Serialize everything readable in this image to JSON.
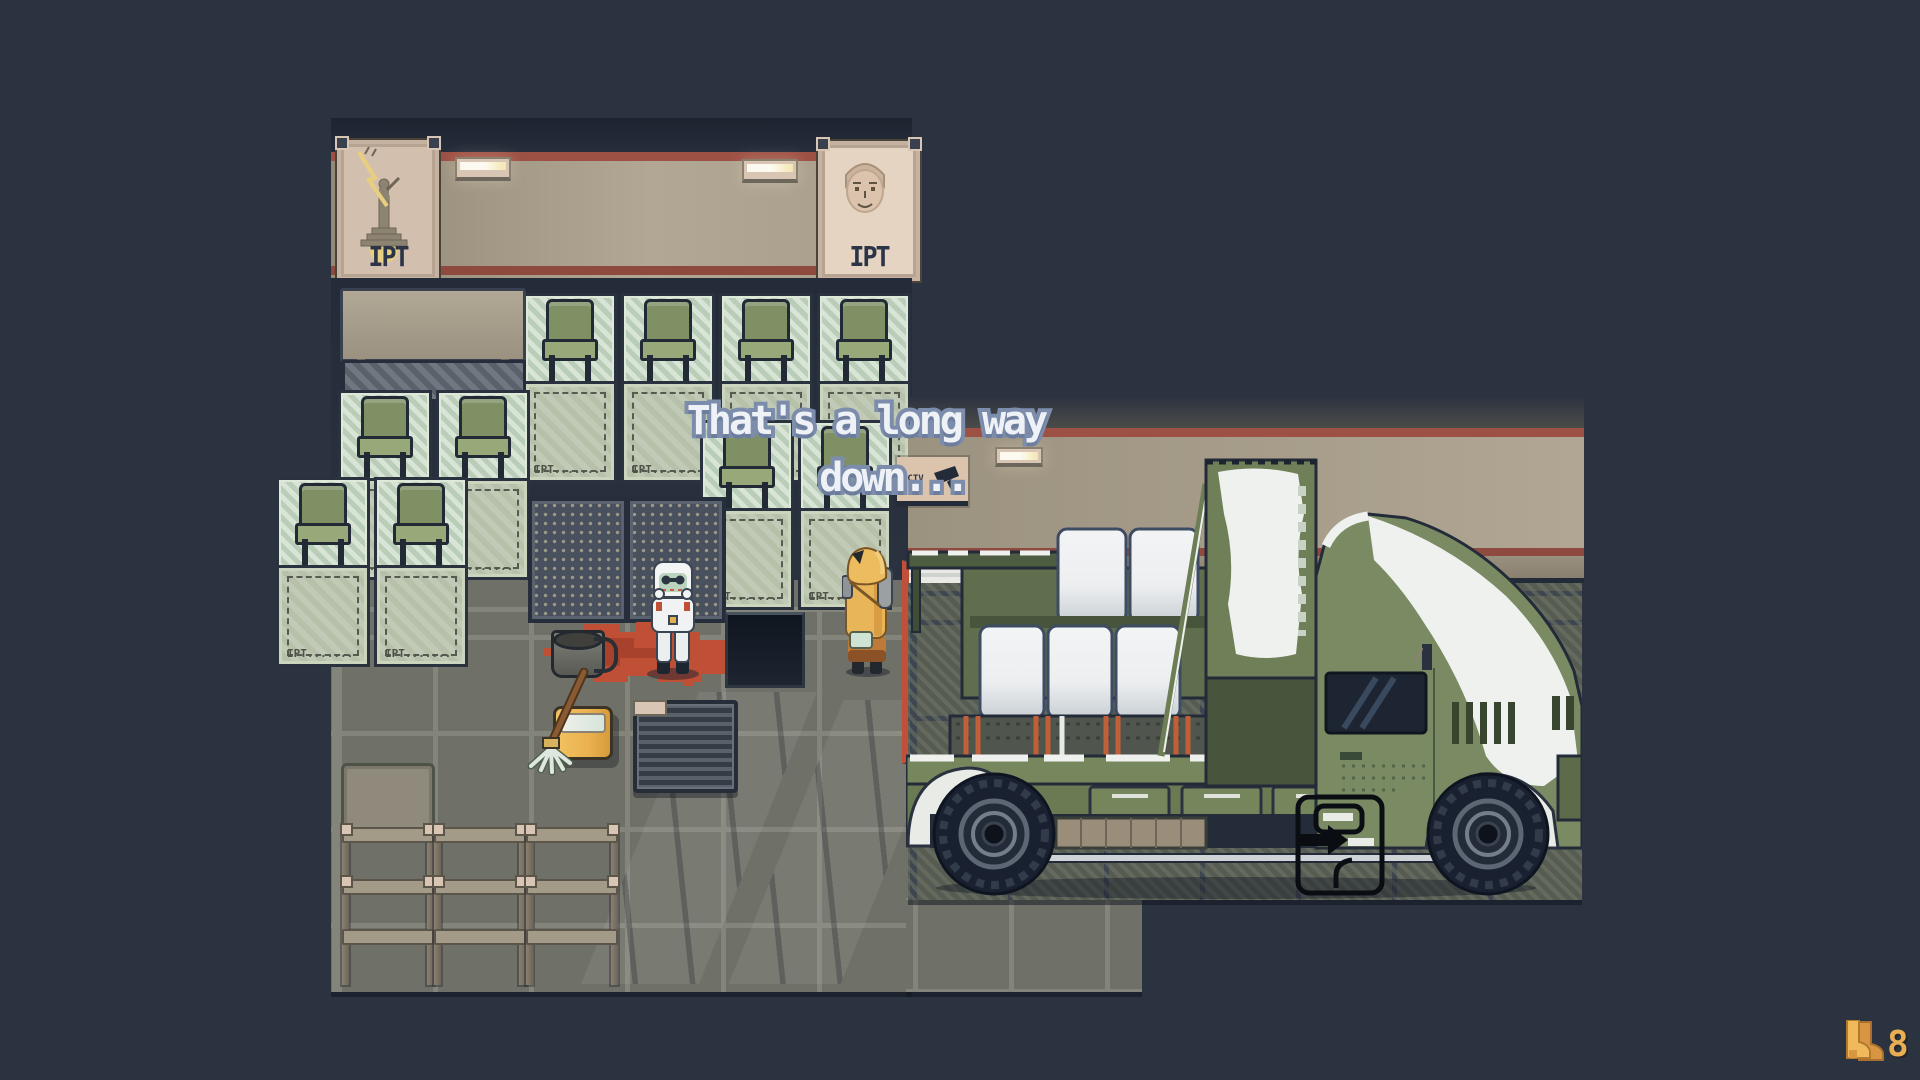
{
  "dialogue": {
    "line1": "That's a long way",
    "line2": "down...",
    "full_text": "That's a long way down..."
  },
  "hud": {
    "count": "8",
    "icon": "boots-icon"
  },
  "waiting_room": {
    "posters": [
      {
        "label": "IPT",
        "art": "monument-lightning-icon"
      },
      {
        "label": "IPT",
        "art": "portrait-face-icon"
      }
    ],
    "booth_floor_label": "IPT......."
  },
  "garage": {
    "cctv_sign": {
      "label": "CCTV",
      "icon": "security-camera-icon"
    },
    "truck": "military-cargo-truck",
    "door_prompt_icon": "door-enter-arrow-icon"
  },
  "characters": [
    {
      "name": "white-hazmat-character"
    },
    {
      "name": "yellow-hazmat-character"
    }
  ],
  "props": [
    "blood-puddle",
    "metal-bucket",
    "mop",
    "mop-bucket",
    "floor-hatch",
    "floor-grille",
    "storage-shelves"
  ],
  "palette": {
    "bg": "#2b3240",
    "wall_tan": "#a89d8b",
    "stripe_red": "#9d5044",
    "ink_dark": "#2c3547",
    "poster_paper": "#d3bfae",
    "accent_yellow": "#e8cf7e",
    "glass_green": "#c6d8c4",
    "chair_green": "#7e9064",
    "pad_green": "#b7c1aa",
    "floor_tile": "#6f7168",
    "floor_grout": "#83857b",
    "garage_tile": "#575c52",
    "blood_red": "#bf4f35",
    "mop_yellow": "#eab14e",
    "truck_green": "#7a8a62",
    "truck_dark": "#5c6b4a",
    "snow_white": "#eef1ee",
    "sack_white": "#eef0f2",
    "tire_dark": "#192030",
    "cab_window": "#1c2531",
    "dialogue_fill": "#eef2f7",
    "dialogue_outline": "#7d8dac",
    "hud_orange": "#e9ad52",
    "cctv_paper": "#dcc3ab"
  }
}
